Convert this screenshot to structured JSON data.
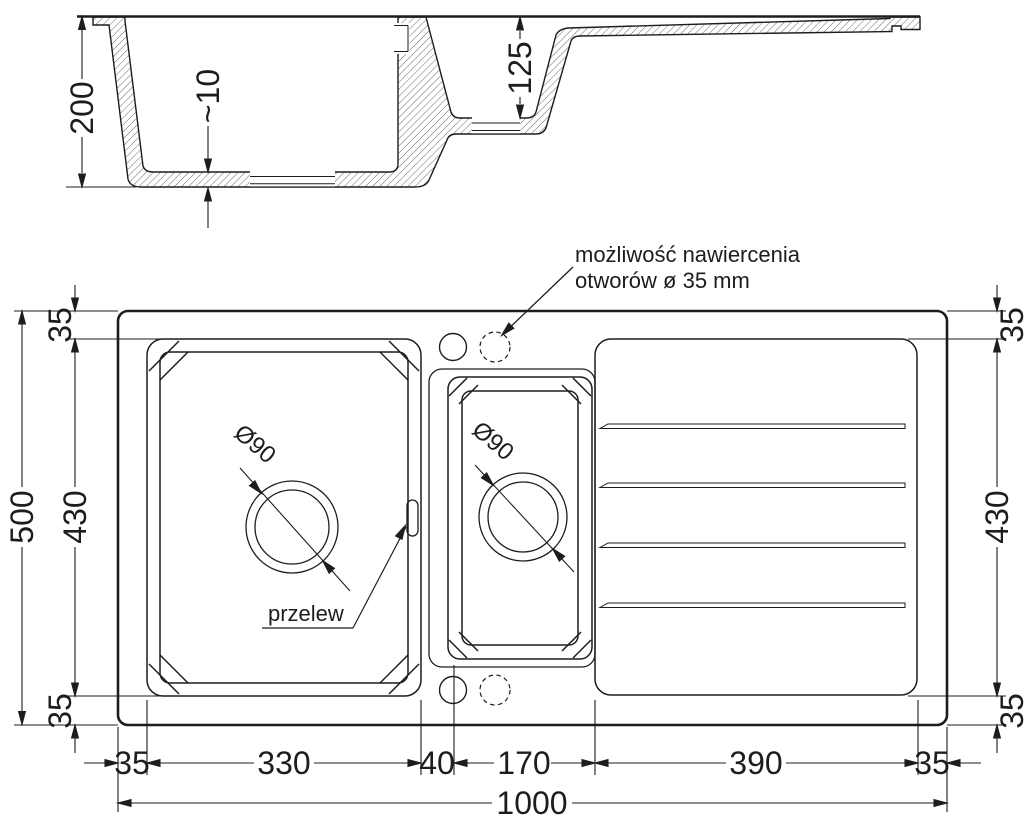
{
  "colors": {
    "ink": "#1d1d1b",
    "hatch": "#5a5a5a",
    "background": "#ffffff"
  },
  "section": {
    "depth": "200",
    "bottom_thickness": "~10",
    "small_bowl_depth": "125"
  },
  "plan": {
    "note_line1": "możliwość nawiercenia",
    "note_line2": "otworów ø 35 mm",
    "overflow_label": "przelew",
    "main_drain_diameter": "Ø90",
    "small_drain_diameter": "Ø90"
  },
  "dims": {
    "total_length": "1000",
    "total_width": "500",
    "left_margin": "35",
    "main_bowl_length": "330",
    "divider_width": "40",
    "small_bowl_length": "170",
    "drainer_length": "390",
    "right_margin": "35",
    "top_margin_left": "35",
    "bowl_width_left": "430",
    "bottom_margin_left": "35",
    "top_margin_right": "35",
    "bowl_width_right": "430",
    "bottom_margin_right": "35"
  }
}
